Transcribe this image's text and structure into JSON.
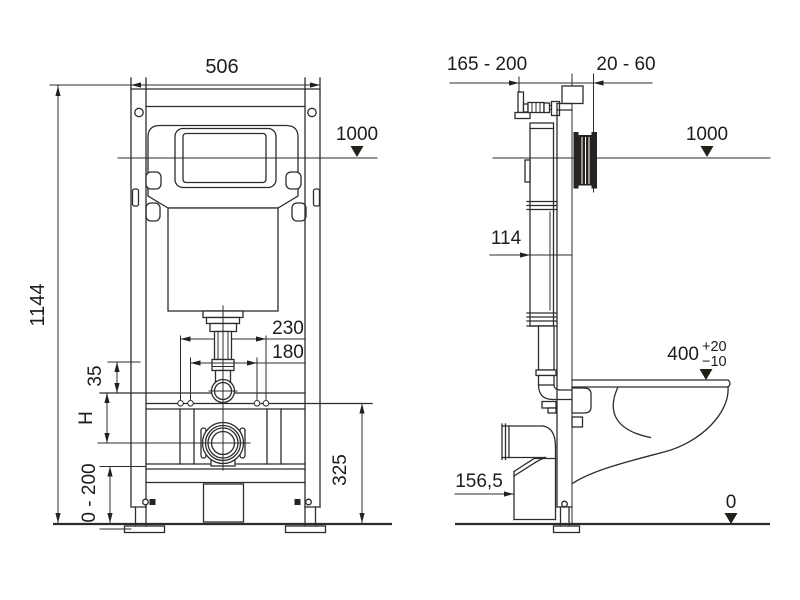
{
  "drawing": {
    "description": "Dimensioned technical line drawing of a wall-hung WC concealed cistern installation frame: front view (left) and side view with bowl (right)",
    "colors": {
      "line": "#2e2c2a",
      "text": "#1d1d1d",
      "protection_block": "#282320",
      "background": "#ffffff"
    }
  },
  "front_view": {
    "frame_width": "506",
    "total_height": "1144",
    "water_level": "1000",
    "fixing_spacing_outer": "230",
    "fixing_spacing_inner": "180",
    "flush_pipe_offset": "35",
    "outlet_height_label": "H",
    "leg_adjustment_range": "0 - 200",
    "outlet_rail_height": "325"
  },
  "side_view": {
    "supply_connection_range": "165 - 200",
    "wall_finish_thickness": "20 - 60",
    "water_level": "1000",
    "cistern_depth": "114",
    "seat_height": "400",
    "seat_height_tol_plus": "+20",
    "seat_height_tol_minus": "−10",
    "outlet_offset": "156,5",
    "floor_level": "0"
  }
}
